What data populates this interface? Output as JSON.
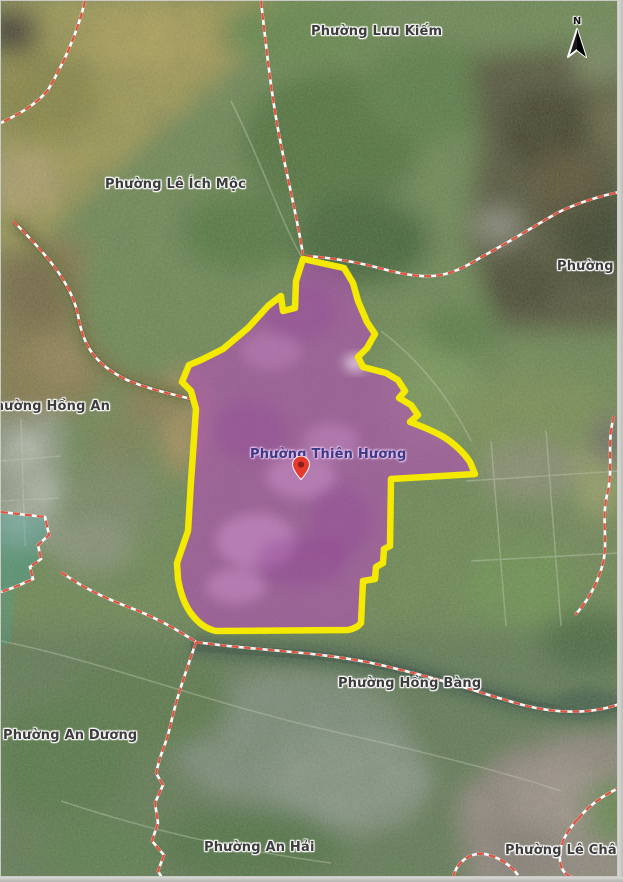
{
  "map": {
    "type": "satellite-basemap-with-ward-boundaries",
    "highlighted_region": {
      "name": "Phường Thiên Hương",
      "fill_color": "#b84fc0",
      "border_color": "#f4e900",
      "marker": "red-location-pin"
    },
    "region_labels": [
      {
        "text": "Phường Lưu Kiếm"
      },
      {
        "text": "Phường Lê Ích Mộc"
      },
      {
        "text": "Phường Hòa"
      },
      {
        "text": "Phường Hồng An"
      },
      {
        "text": "Phường Thiên Hương"
      },
      {
        "text": "Phường Hồng Bàng"
      },
      {
        "text": "Phường An Dương"
      },
      {
        "text": "Phường An Hải"
      },
      {
        "text": "Phường Lê Chân"
      }
    ],
    "compass_label": "N",
    "boundary_line_color": "#e0513f",
    "water_color": "#47624e"
  }
}
